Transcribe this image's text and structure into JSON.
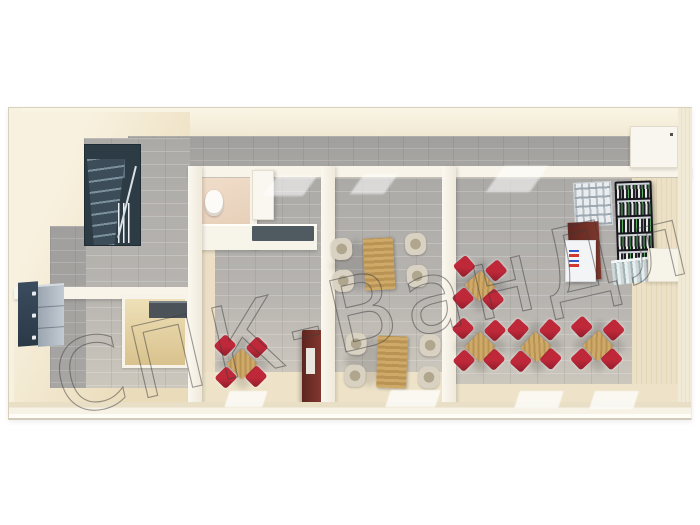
{
  "meta": {
    "description": "3D top-down architectural render of a modular canteen building floor plan",
    "rooms": [
      "entry-hall-with-staircase",
      "washroom",
      "small-dining-room",
      "medium-dining-room",
      "large-dining-hall"
    ]
  },
  "watermark": {
    "text": "СПК-ВанДл",
    "color": "#3c3c3c"
  },
  "palette": {
    "wall_cream": "#f4ecda",
    "wall_white": "#f8f4e9",
    "floor_beige": "#eee3c9",
    "floor_tile_grey": "#acaaa7",
    "chair_red": "#be2839",
    "chair_cream": "#d9d2c2",
    "table_wood": "#cfa967",
    "stairs_dark": "#2d3b45",
    "locker_navy": "#31404f",
    "cabinet_burgundy": "#6f2d27",
    "rack_black": "#15151b"
  },
  "furniture": {
    "dining_sets": [
      {
        "id": "room-b-set-1",
        "style": "cross",
        "chair": "red",
        "cx": 242,
        "cy": 364,
        "rot": 0
      },
      {
        "id": "room-c-set-1",
        "style": "side",
        "chair": "cream",
        "cx": 379,
        "cy": 264,
        "rot": -3
      },
      {
        "id": "room-c-set-2",
        "style": "side",
        "chair": "cream",
        "cx": 392,
        "cy": 362,
        "rot": 2
      },
      {
        "id": "room-d-set-1",
        "style": "cross",
        "chair": "red",
        "cx": 480,
        "cy": 286,
        "rot": 4
      },
      {
        "id": "room-d-set-2",
        "style": "cross",
        "chair": "red",
        "cx": 480,
        "cy": 347,
        "rot": 0
      },
      {
        "id": "room-d-set-3",
        "style": "cross",
        "chair": "red",
        "cx": 536,
        "cy": 347,
        "rot": -3
      },
      {
        "id": "room-d-set-4",
        "style": "cross",
        "chair": "red",
        "cx": 598,
        "cy": 346,
        "rot": 2
      }
    ],
    "floor_mats": [
      {
        "x": 227,
        "y": 391,
        "w": 38,
        "h": 16
      },
      {
        "x": 388,
        "y": 390,
        "w": 50,
        "h": 17
      },
      {
        "x": 517,
        "y": 391,
        "w": 44,
        "h": 17
      },
      {
        "x": 592,
        "y": 391,
        "w": 44,
        "h": 18
      }
    ],
    "window_light_strips": [
      {
        "x": 270,
        "y": 176,
        "w": 40,
        "h": 20
      },
      {
        "x": 357,
        "y": 174,
        "w": 34,
        "h": 20
      },
      {
        "x": 495,
        "y": 166,
        "w": 44,
        "h": 26
      }
    ]
  }
}
